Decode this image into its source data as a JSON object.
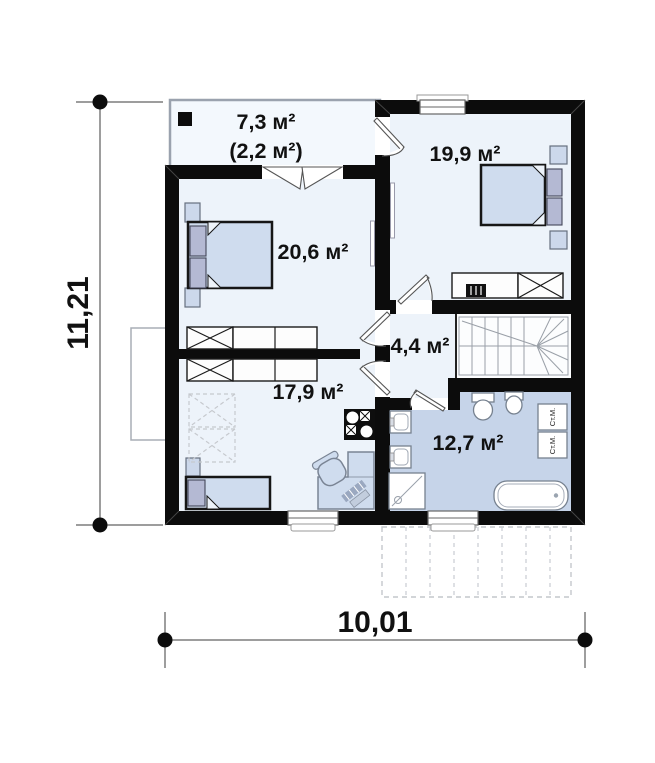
{
  "plan": {
    "type": "floor-plan",
    "dimensions": {
      "height_label": "11,21",
      "width_label": "10,01"
    },
    "rooms": {
      "balcony": {
        "area": "7,3 м²",
        "area_note": "(2,2 м²)"
      },
      "bedroom_right": {
        "area": "19,9 м²"
      },
      "bedroom_left": {
        "area": "20,6 м²"
      },
      "hallway": {
        "area": "4,4 м²"
      },
      "room_lower": {
        "area": "17,9 м²"
      },
      "bathroom": {
        "area": "12,7 м²"
      }
    },
    "appliances": {
      "washer_top": "Ст.М.",
      "washer_bottom": "Ст.М."
    },
    "colors": {
      "wall": "#0c0c0c",
      "room_floor": "#edf3fa",
      "balcony_floor": "#f3f8fd",
      "bathroom_floor": "#c6d4e9",
      "furniture_fill": "#cfdcee",
      "pillow_fill": "#b4b9d3",
      "dimension_line": "#7d7d7d"
    }
  }
}
